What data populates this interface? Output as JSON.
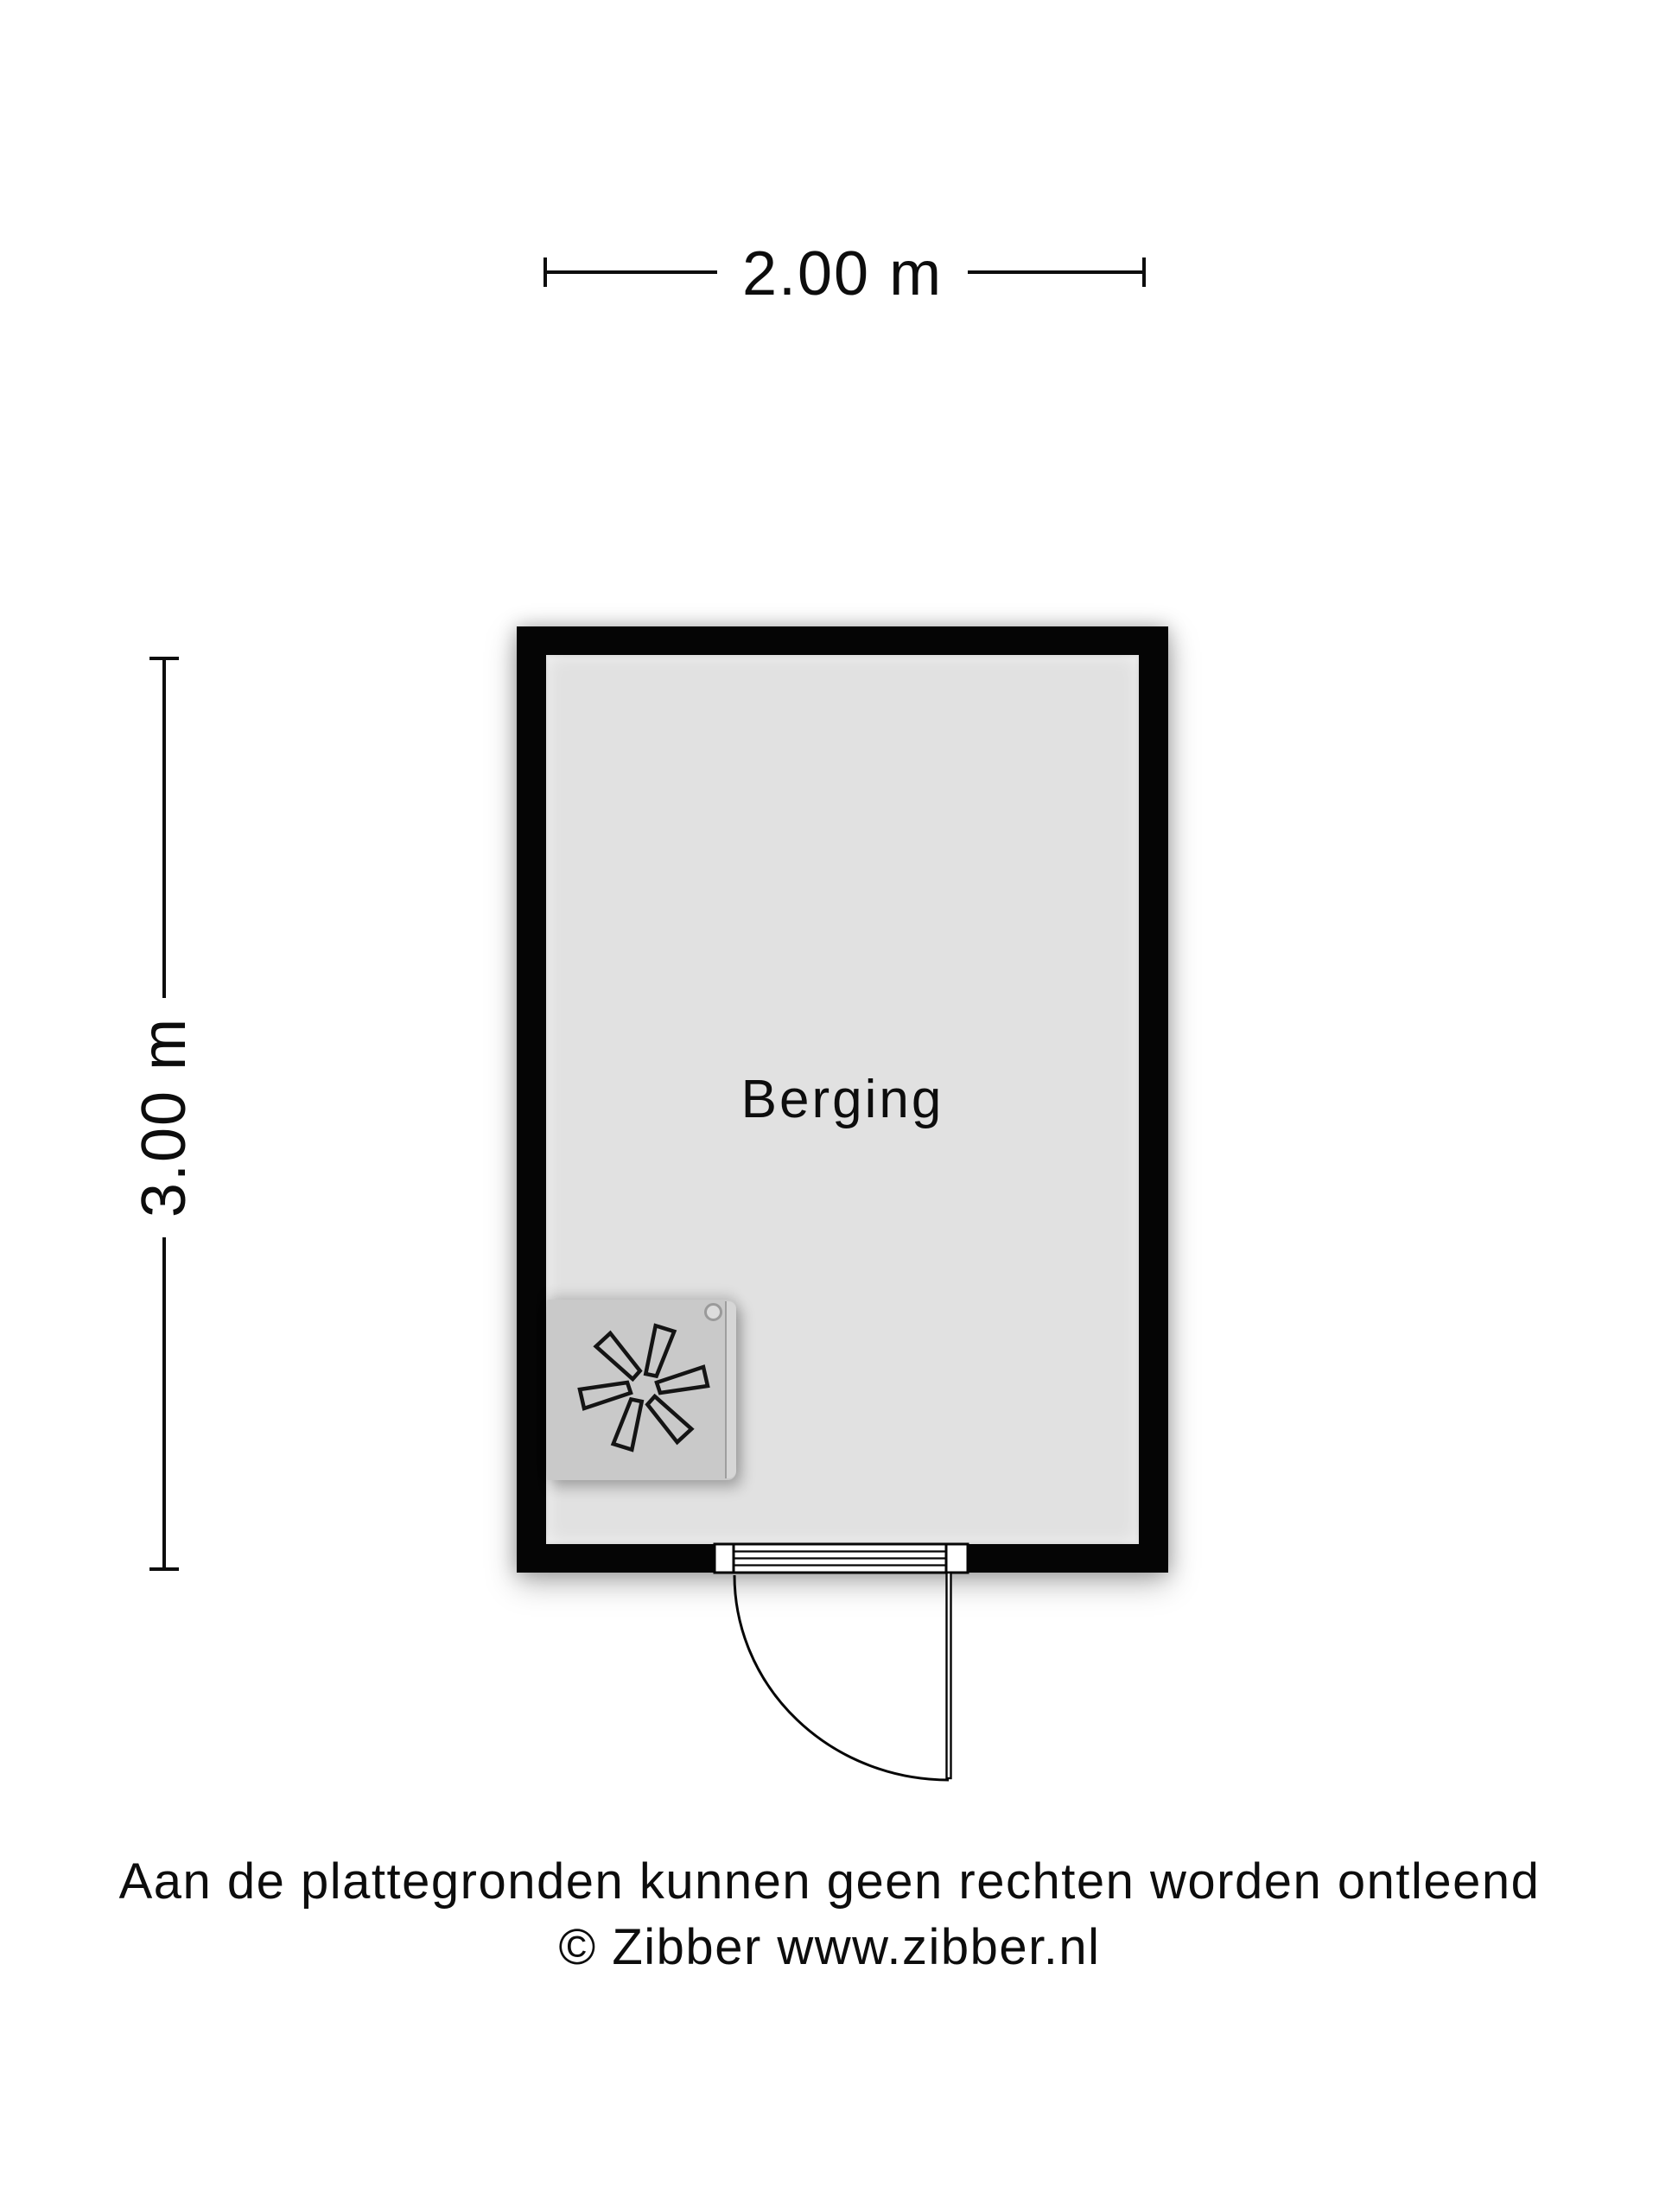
{
  "plan": {
    "room": {
      "label": "Berging"
    },
    "dimensions": {
      "width": "2.00 m",
      "height": "3.00 m"
    },
    "footer": {
      "line1": "Aan de plattegronden kunnen geen rechten worden ontleend",
      "line2": "© Zibber www.zibber.nl"
    }
  },
  "icons": {
    "fan": "fan-icon",
    "door": "door-swing"
  },
  "colors": {
    "wall": "#050505",
    "floor": "#e1e1e1",
    "unit": "#c9c9c9",
    "unit_lid": "#d6d6d6",
    "ink": "#0d0d0d",
    "background": "#ffffff"
  }
}
